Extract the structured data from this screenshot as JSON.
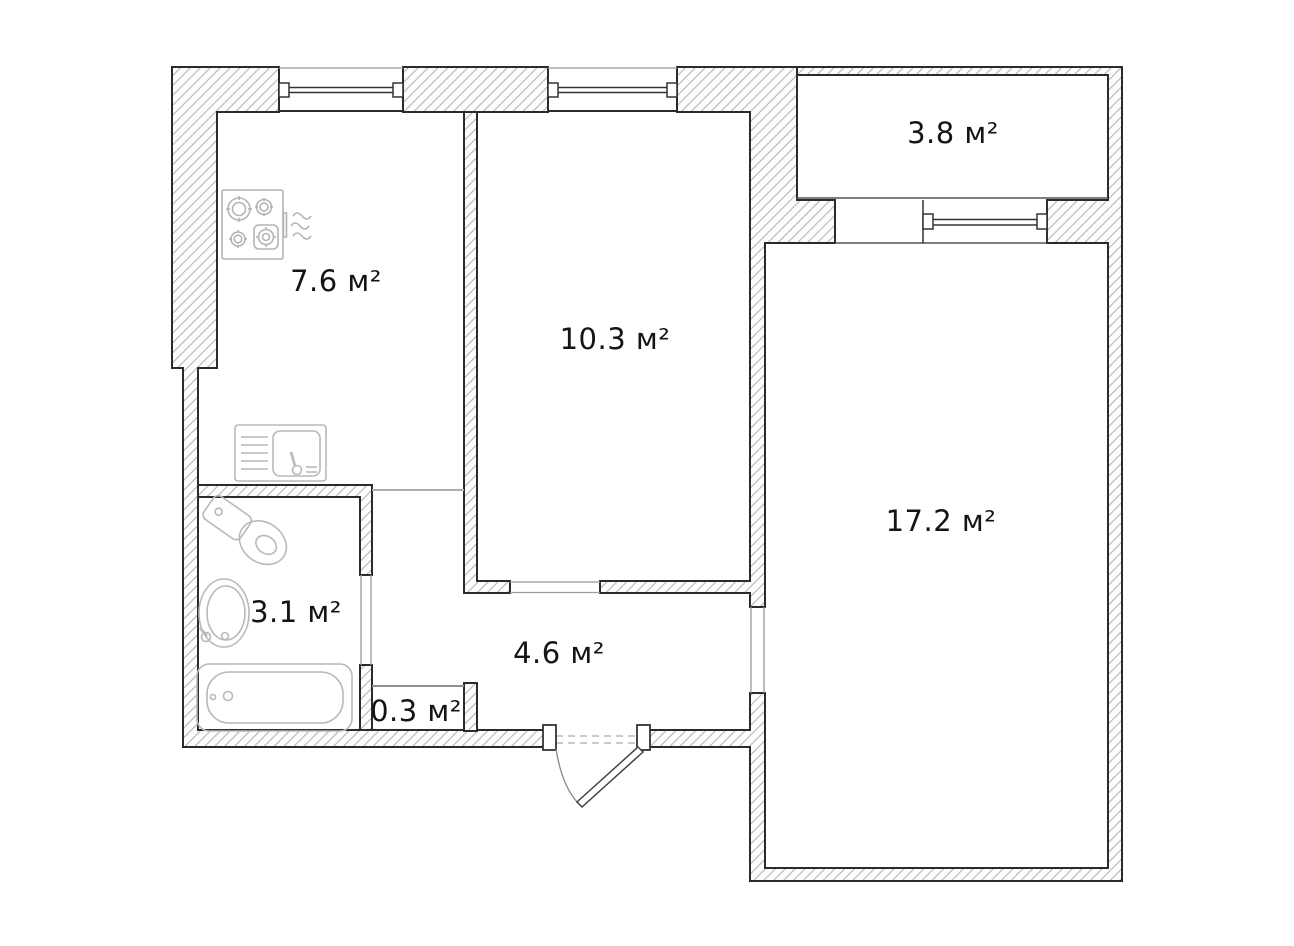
{
  "floor_plan": {
    "unit_suffix": "м²",
    "rooms": [
      {
        "name": "kitchen",
        "area_label": "7.6 м²"
      },
      {
        "name": "bedroom",
        "area_label": "10.3 м²"
      },
      {
        "name": "balcony",
        "area_label": "3.8 м²"
      },
      {
        "name": "living-room",
        "area_label": "17.2 м²"
      },
      {
        "name": "bathroom",
        "area_label": "3.1 м²"
      },
      {
        "name": "hallway",
        "area_label": "4.6 м²"
      },
      {
        "name": "storage",
        "area_label": "0.3 м²"
      }
    ],
    "fixtures": [
      "stove-icon",
      "vent-waves-icon",
      "kitchen-sink-icon",
      "toilet-icon",
      "washbasin-icon",
      "bathtub-icon",
      "entrance-door-icon",
      "window-icon"
    ],
    "colors": {
      "background": "#ffffff",
      "wall_hatch_line": "#b5b5b5",
      "wall_fill": "#fdfdfd",
      "wall_outline": "#2b2b2b",
      "thin_line": "#999999",
      "fixture_stroke": "#b9b9b9",
      "label_text": "#141414"
    }
  }
}
